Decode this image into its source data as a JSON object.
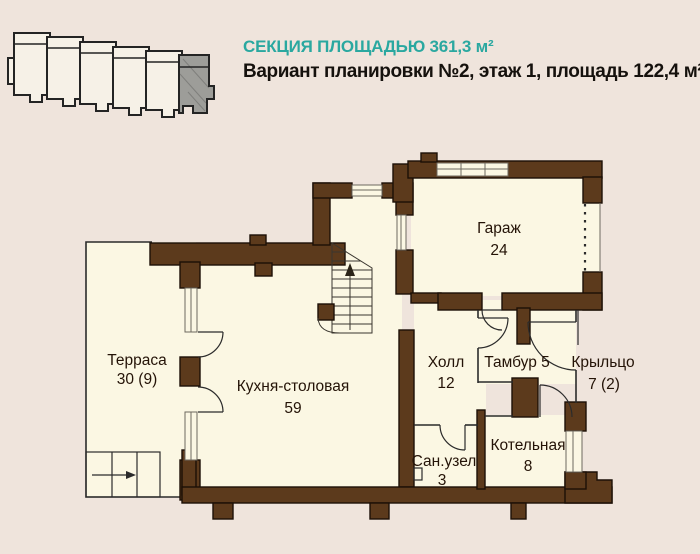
{
  "page": {
    "background": "#efe4dc"
  },
  "header": {
    "title": "СЕКЦИЯ ПЛОЩАДЬЮ 361,3 м²",
    "subtitle": "Вариант планировки №2, этаж 1, площадь 122,4 м²",
    "title_color": "#2aa8a0",
    "subtitle_color": "#15110d"
  },
  "site_plan": {
    "sections_total": 6,
    "highlighted_section": "rightmost",
    "highlight_color": "#9d9d99",
    "outline_color": "#242424"
  },
  "floor_plan": {
    "wall_color": "#5c3a1c",
    "room_fill": "#fbf7e3",
    "rooms": [
      {
        "id": "terrace",
        "name": "Терраса",
        "area": "30  (9)"
      },
      {
        "id": "kitchen",
        "name": "Кухня-столовая",
        "area": "59"
      },
      {
        "id": "garage",
        "name": "Гараж",
        "area": "24"
      },
      {
        "id": "hall",
        "name": "Холл",
        "area": "12"
      },
      {
        "id": "tambour",
        "name": "Тамбур 5",
        "area": ""
      },
      {
        "id": "porch",
        "name": "Крыльцо",
        "area": "7 (2)"
      },
      {
        "id": "bathroom",
        "name": "Сан.узел",
        "area": "3"
      },
      {
        "id": "boiler",
        "name": "Котельная",
        "area": "8"
      }
    ]
  }
}
